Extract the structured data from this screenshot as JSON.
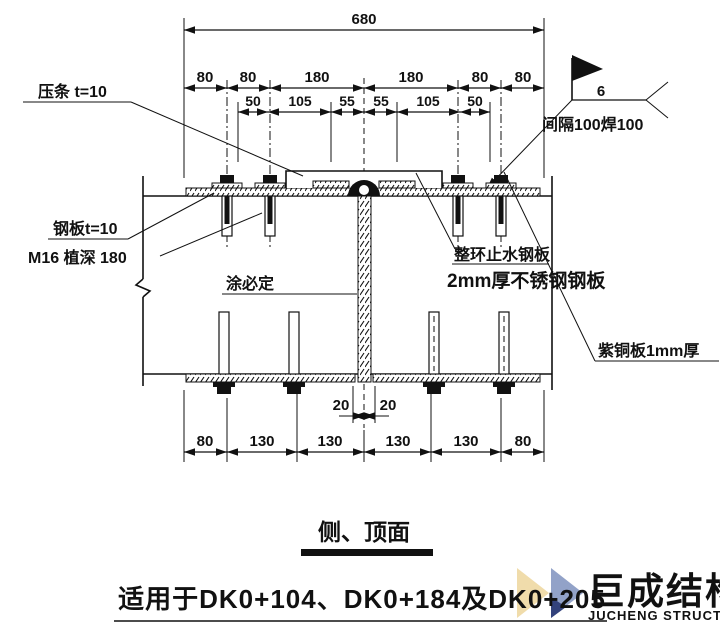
{
  "drawing": {
    "title": "侧、顶面",
    "note": "适用于DK0+104、DK0+184及DK0+205"
  },
  "labels": {
    "pressure_strip": "压条 t=10",
    "steel_plate": "钢板t=10",
    "anchor": "M16 植深 180",
    "sealant": "涂必定",
    "waterstop_line1": "整环止水钢板",
    "waterstop_line2": "2mm厚不锈钢钢板",
    "copper_plate": "紫铜板1mm厚",
    "weld_size": "6",
    "weld_note": "间隔100焊100"
  },
  "dimensions": {
    "overall": "680",
    "row2": [
      "80",
      "80",
      "180",
      "180",
      "80",
      "80"
    ],
    "row3": [
      "50",
      "105",
      "55",
      "55",
      "105",
      "50"
    ],
    "joint": [
      "20",
      "20"
    ],
    "bottom": [
      "80",
      "130",
      "130",
      "130",
      "130",
      "80"
    ]
  },
  "watermark": {
    "cn": "巨成结构",
    "en": "JUCHENG STRUCTURE",
    "colors": {
      "cream": "#f0dcab",
      "blue": "#92a2c8",
      "navy": "#33427c",
      "cn_text": "#aab6d6",
      "en_text": "#a9b0ba"
    }
  }
}
